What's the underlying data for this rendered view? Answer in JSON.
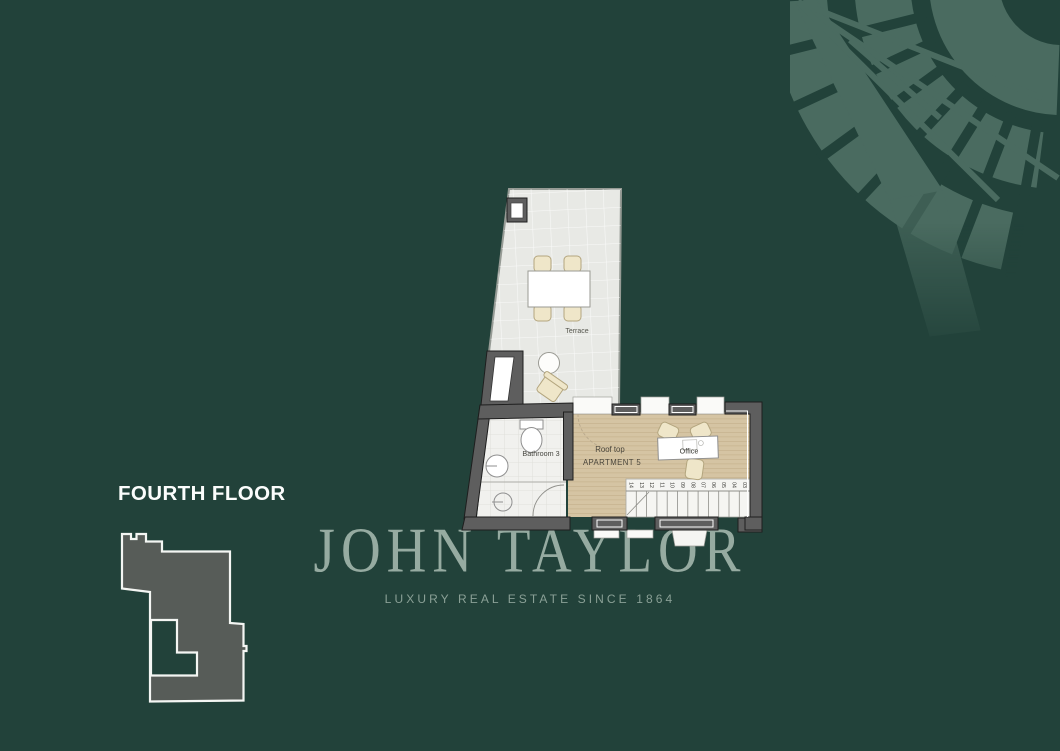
{
  "floor": {
    "label": "FOURTH FLOOR"
  },
  "brand": {
    "name": "JOHN TAYLOR",
    "tagline": "LUXURY REAL ESTATE SINCE 1864"
  },
  "plan": {
    "terrace_label": "Terrace",
    "bathroom_label": "Bathroom 3",
    "rooftop_label_line1": "Roof top",
    "rooftop_label_line2": "APARTMENT 5",
    "office_label": "Office",
    "stair_steps": [
      "14",
      "13",
      "12",
      "11",
      "10",
      "09",
      "08",
      "07",
      "06",
      "05",
      "04",
      "03"
    ]
  },
  "colors": {
    "background": "#22423a",
    "pattern": "#6b8d7f",
    "brand_text": "#9db1a7",
    "tagline_text": "#8aa096",
    "floor_label_text": "#fbfdfc",
    "terrace_floor": "#e8e9e5",
    "wood_floor": "#d5c4a3",
    "bathroom_floor": "#f1f1ee",
    "wall": "#5e5e5e",
    "footprint": "#575c58",
    "footprint_outline": "#f4f6f3"
  }
}
